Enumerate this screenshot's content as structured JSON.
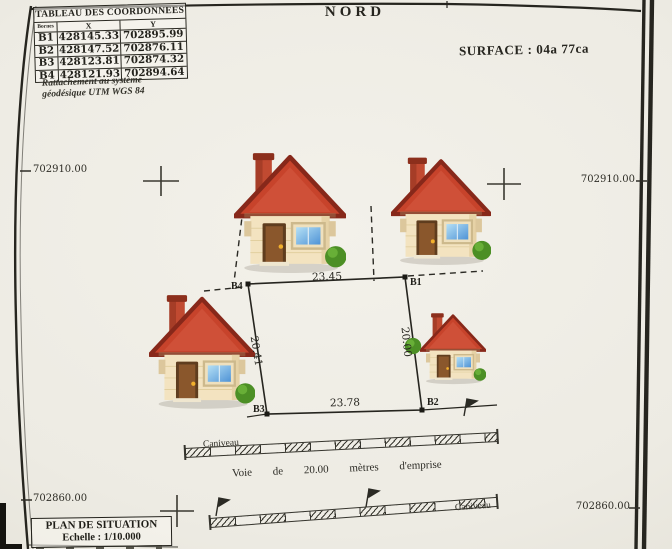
{
  "header": {
    "north": "NORD",
    "surface": "SURFACE :  04a 77ca"
  },
  "coord_table": {
    "title": "TABLEAU DES COORDONNEES",
    "col_borne": "Bornes",
    "col_x": "X",
    "col_y": "Y",
    "rows": [
      {
        "borne": "B1",
        "x": "428145.33",
        "y": "702895.99"
      },
      {
        "borne": "B2",
        "x": "428147.52",
        "y": "702876.11"
      },
      {
        "borne": "B3",
        "x": "428123.81",
        "y": "702874.32"
      },
      {
        "borne": "B4",
        "x": "428121.93",
        "y": "702894.64"
      }
    ],
    "note_line1": "Rattachement au système",
    "note_line2": "géodésique UTM WGS 84"
  },
  "grid": {
    "top_left": "702910.00",
    "top_right": "702910.00",
    "bottom_left": "702860.00",
    "bottom_right": "702860.00"
  },
  "parcel": {
    "b1": "B1",
    "b2": "B2",
    "b3": "B3",
    "b4": "B4",
    "dim_top": "23.45",
    "dim_left": "20.41",
    "dim_right": "20.00",
    "dim_bottom": "23.78"
  },
  "road": {
    "axis_label": "Voie de 20.00 mètres d'emprise",
    "caniveau_upper": "Caniveau",
    "caniveau_lower": "Caniveau"
  },
  "footer": {
    "title": "PLAN DE SITUATION",
    "scale": "Echelle : 1/10.000"
  },
  "icons": {
    "house": "house-icon",
    "bush": "bush-icon",
    "flag": "survey-flag-icon",
    "cross": "grid-cross-icon"
  },
  "colors": {
    "ink": "#2b2a24",
    "paper": "#edebe3",
    "roof": "#c7432b",
    "roof_dark": "#87281a",
    "wall": "#f3e3c0",
    "wall_shade": "#e6d2a6",
    "door": "#8a572c",
    "door_dark": "#5f3d1e",
    "window_light": "#b5e0f5",
    "window_dark": "#4f93d6",
    "bush": "#4c8f25",
    "bush_light": "#68af37",
    "knob": "#f2b02c"
  }
}
